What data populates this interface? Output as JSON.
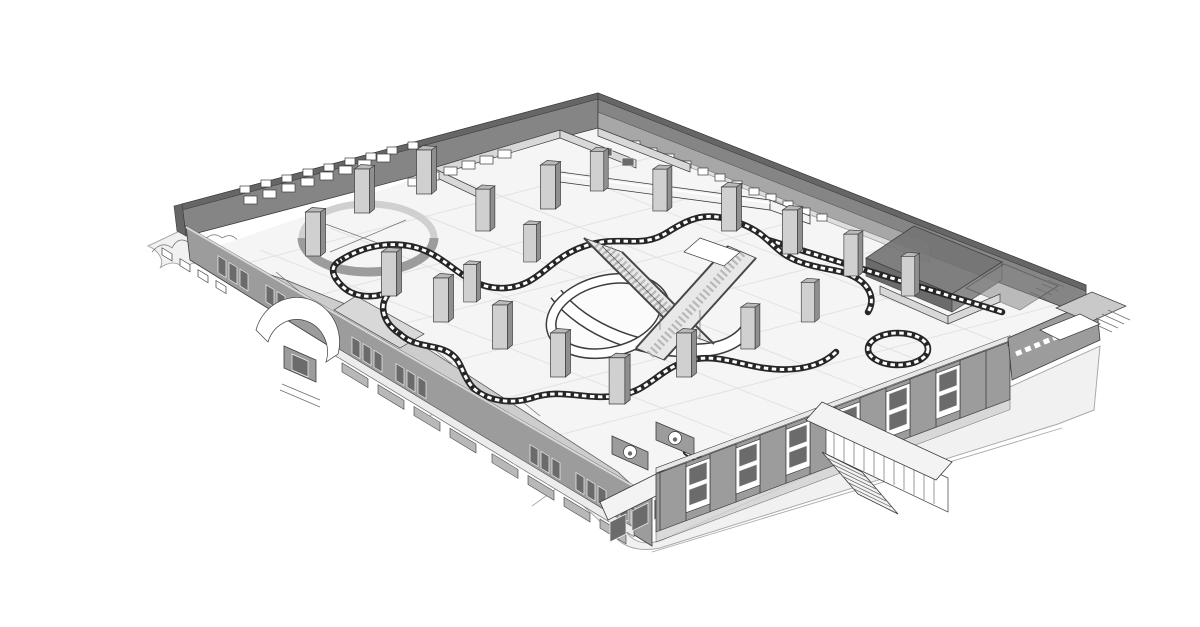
{
  "figure": {
    "kind": "architectural-3d-axonometric-model",
    "subject": "building-interior-cutaway-rendering",
    "background": "#ffffff"
  },
  "palette": {
    "outline": "#3c3c3c",
    "wall_dark": "#858585",
    "wall_darker": "#666666",
    "wall_medium": "#9c9c9c",
    "wall_light": "#c9c9c9",
    "partition": "#d8d8d8",
    "floor": "#f5f5f5",
    "floor_line": "#e2e2e2",
    "pavement": "#f1f1f1",
    "pavement_edge": "#a9a9a9",
    "column_face": "#d0d0d0",
    "column_side": "#8f8f8f",
    "column_top": "#b9b9b9",
    "glass_dark": "#6b6b6b",
    "white": "#ffffff",
    "rail_dark": "#262626",
    "canopy": "#f3f3f3",
    "awning": "#ececec",
    "storefront": "#b8b8b8",
    "annex_dark": "#757575"
  },
  "scene": {
    "parts": [
      "site-pavement",
      "street-curb",
      "hedge-outline",
      "interior-floor",
      "floor-grid",
      "back-left-wall",
      "back-right-wall",
      "clerestory-windows",
      "interior-windows",
      "partition-rooms",
      "counter-units",
      "rotunda-wall",
      "walkway-bridge",
      "atrium-well-ring",
      "escalator-banks",
      "serpentine-balustrades",
      "columns",
      "front-left-facade",
      "entrance-arch",
      "awning-band",
      "storefront-glass",
      "corner-bay-oval-windows",
      "front-right-facade",
      "facade-piers",
      "exterior-stair-canopy",
      "right-wing",
      "loading-dock",
      "annex-room-boxes"
    ]
  }
}
